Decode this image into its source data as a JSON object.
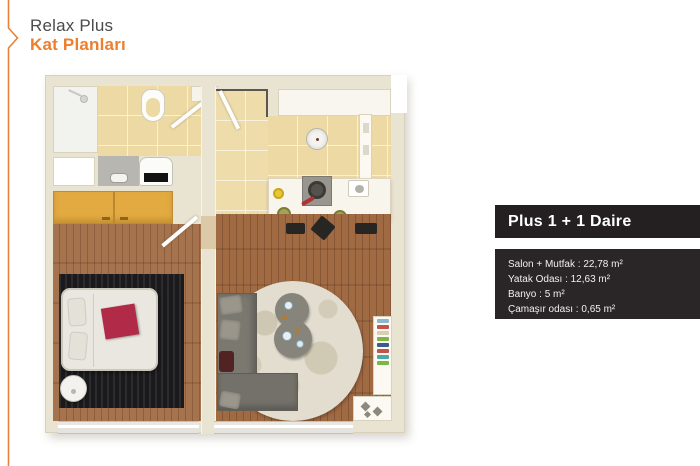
{
  "header": {
    "title": "Relax Plus",
    "subtitle": "Kat Planları"
  },
  "panel": {
    "title": "Plus 1 + 1 Daire",
    "specs": [
      "Salon + Mutfak : 22,78 m²",
      "Yatak Odası : 12,63 m²",
      "Banyo : 5 m²",
      "Çamaşır odası : 0,65 m²"
    ]
  },
  "colors": {
    "accent_orange": "#ee7e2c",
    "title_text": "#4b4b4d",
    "panel_title_bg": "#242021",
    "panel_specs_bg": "#2a2627",
    "wall_cream": "#e9e3d1",
    "tile_beige": "#ecd9a4",
    "wood_brown": "#9a6744",
    "rug_black": "#1a1a1d",
    "blanket_red": "#b12b48",
    "wardrobe_orange": "#e3aa41"
  }
}
